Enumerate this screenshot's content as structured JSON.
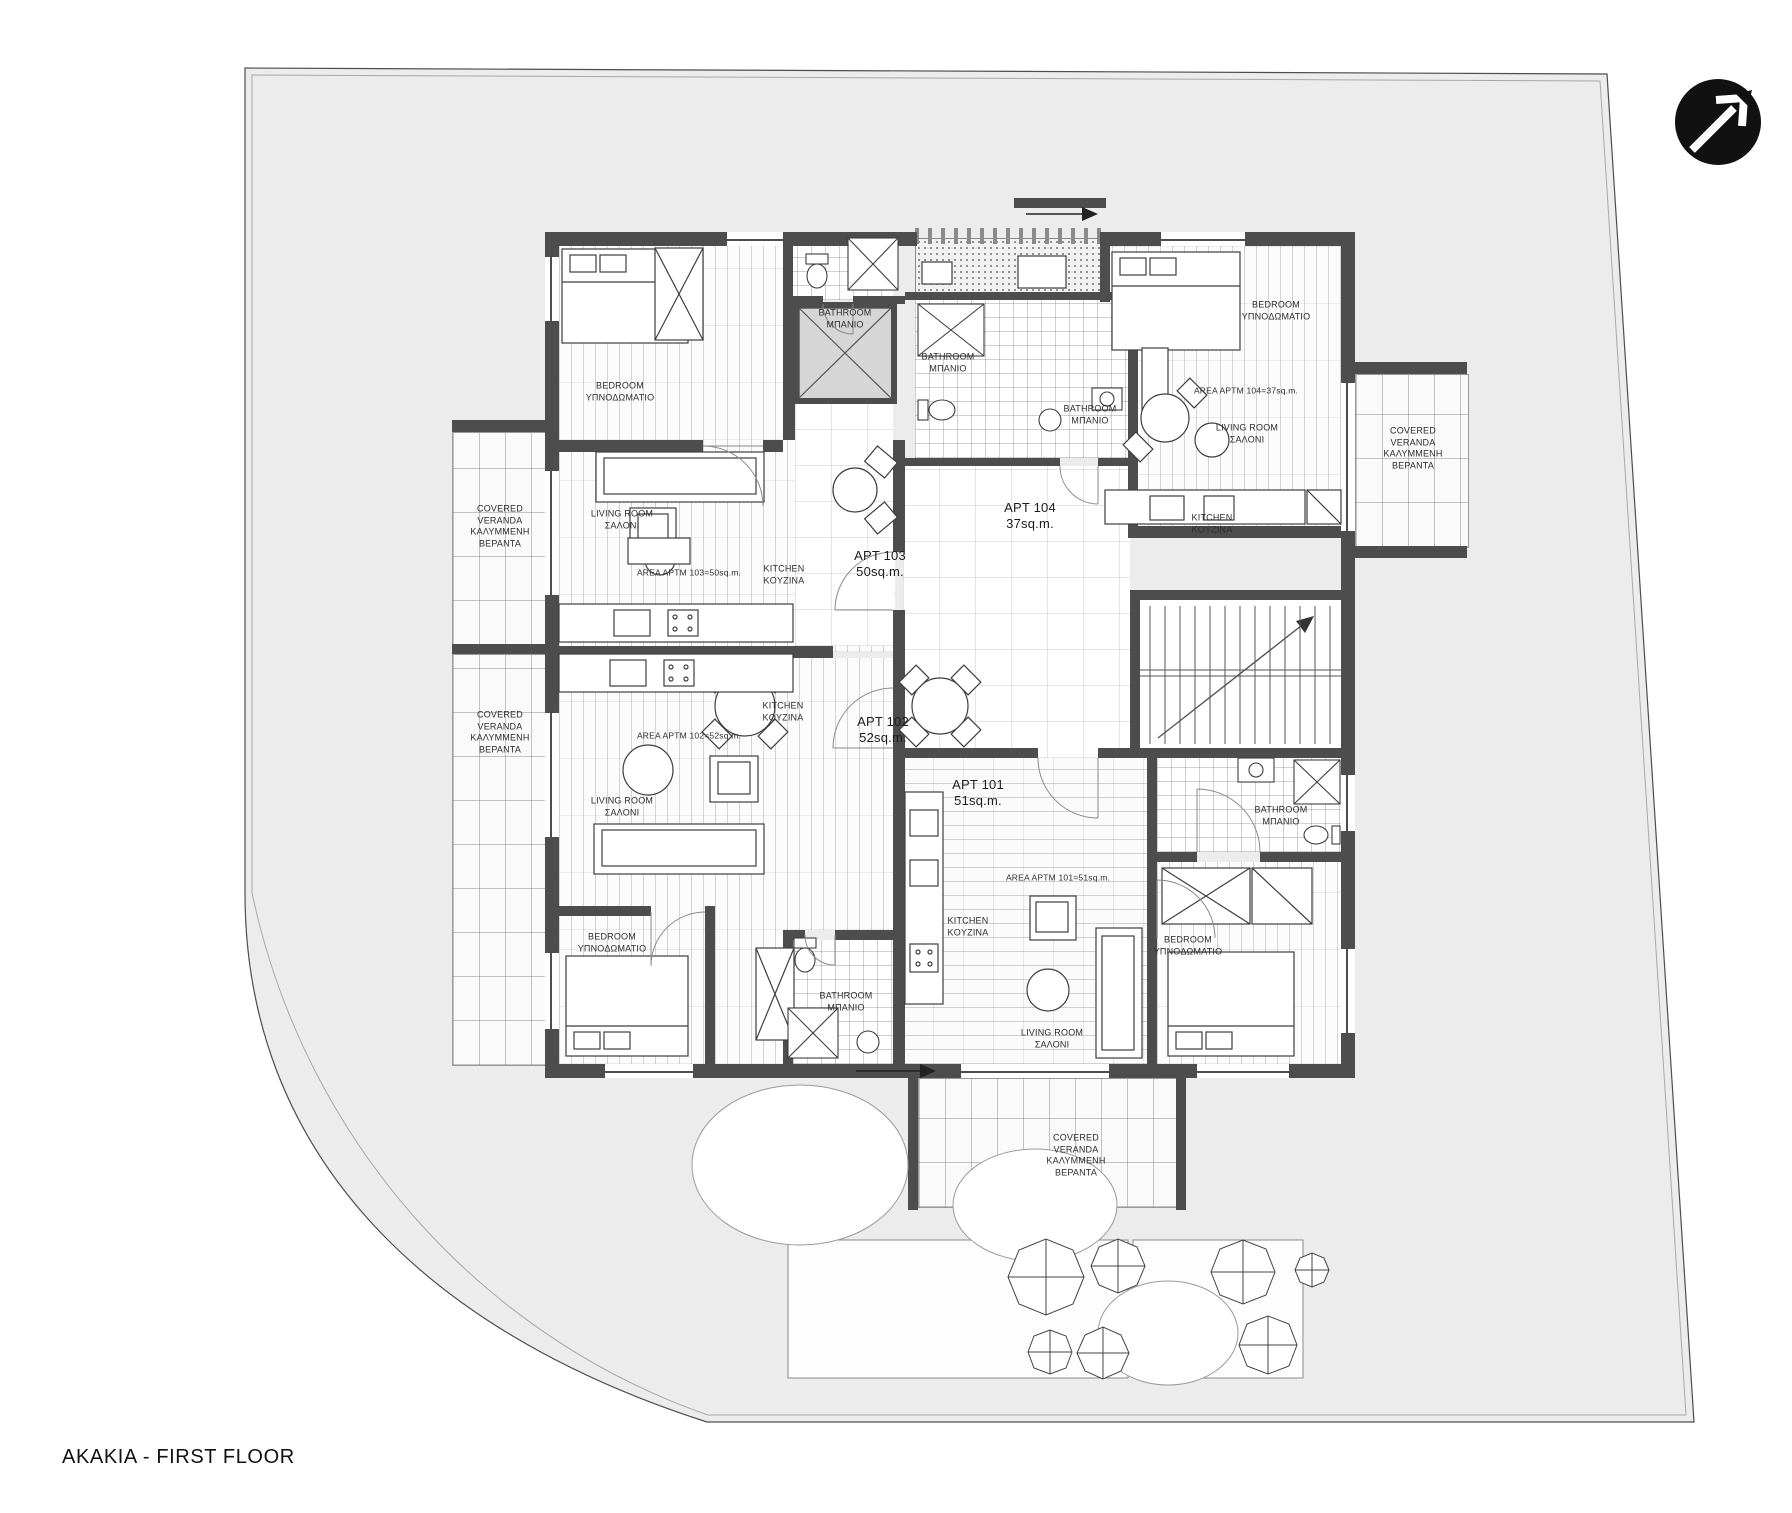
{
  "title": "AKAKIA - FIRST FLOOR",
  "logo": "north-arrow-logo",
  "labels": {
    "bedroom": [
      "BEDROOM",
      "ΥΠΝΟΔΩΜΑΤΙΟ"
    ],
    "bathroom": [
      "BATHROOM",
      "ΜΠΑΝΙΟ"
    ],
    "living_room": [
      "LIVING ROOM",
      "ΣΑΛΟΝΙ"
    ],
    "kitchen": [
      "KITCHEN",
      "KOYZINA"
    ],
    "veranda": [
      "COVERED",
      "VERANDA",
      "ΚΑΛΥΜΜΕΝΗ",
      "ΒΕΡΑΝΤΑ"
    ]
  },
  "apartments": {
    "apt101": {
      "name": "APT 101",
      "area": "51sq.m.",
      "area_note": "AREA APTM 101=51sq.m."
    },
    "apt102": {
      "name": "APT 102",
      "area": "52sq.m.",
      "area_note": "AREA APTM 102=52sq.m."
    },
    "apt103": {
      "name": "APT 103",
      "area": "50sq.m.",
      "area_note": "AREA APTM 103=50sq.m."
    },
    "apt104": {
      "name": "APT 104",
      "area": "37sq.m.",
      "area_note": "AREA APTM 104=37sq.m."
    }
  }
}
